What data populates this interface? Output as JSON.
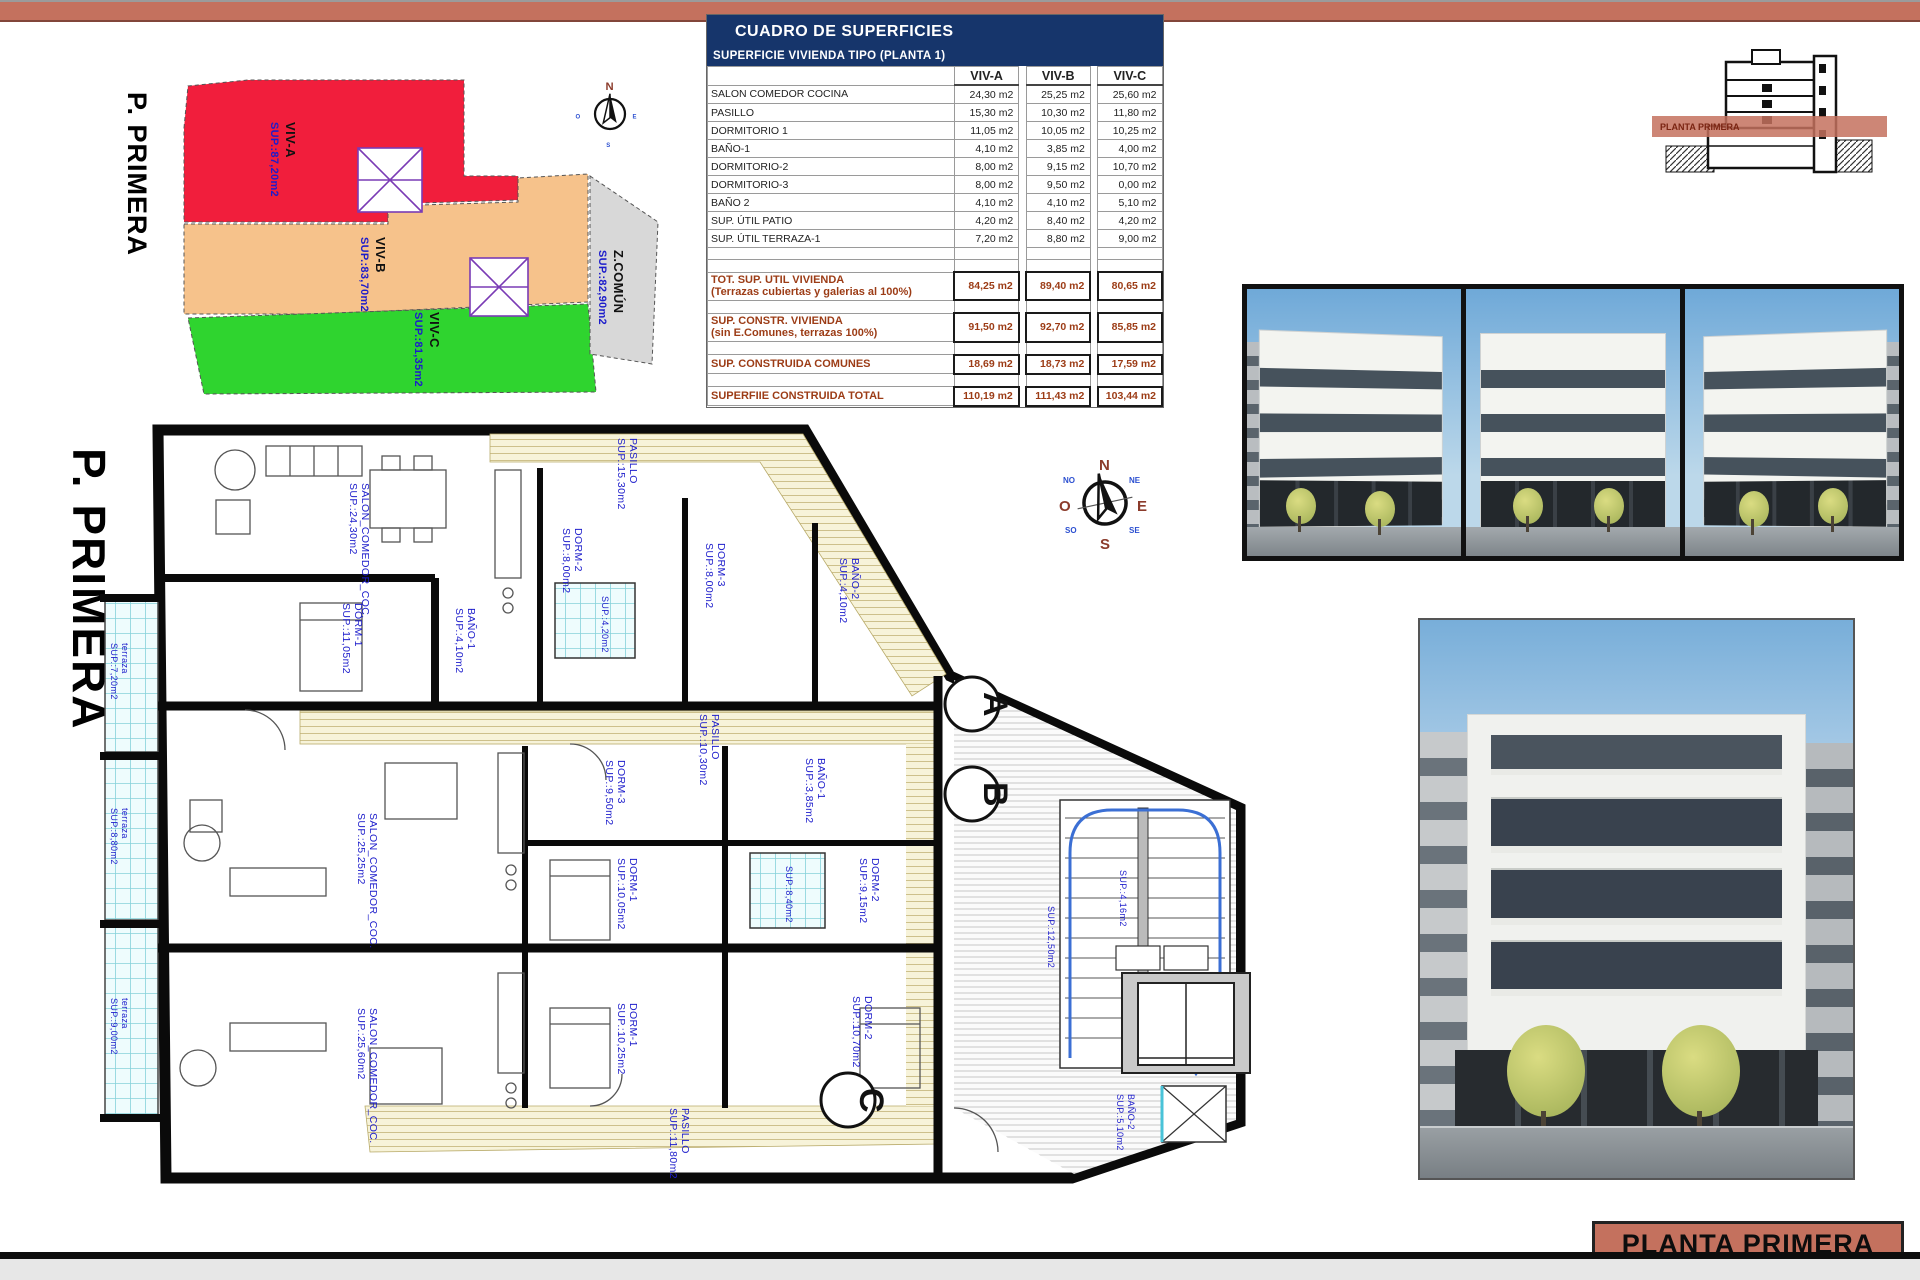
{
  "sheet": {
    "floor_label": "P. PRIMERA",
    "title_block_label": "PLANTA PRIMERA"
  },
  "colors": {
    "accent_salmon": "#c4715e",
    "table_header_navy": "#16356b",
    "zone_red": "#f11e3c",
    "zone_orange": "#f6c28b",
    "zone_green": "#2fd42f",
    "zone_grey": "#d8d8d8",
    "label_blue": "#1c1ccb",
    "summary_maroon": "#9c3c16"
  },
  "key_plan": {
    "floor_label": "P. PRIMERA",
    "zones": [
      {
        "name": "VIV-A",
        "area": "SUP.:87,20m2"
      },
      {
        "name": "VIV-B",
        "area": "SUP.:83,70m2"
      },
      {
        "name": "VIV-C",
        "area": "SUP.:81,35m2"
      },
      {
        "name": "Z.COMÚN",
        "area": "SUP.:82,90m2"
      }
    ]
  },
  "table": {
    "title": "CUADRO DE SUPERFICIES",
    "subtitle": "SUPERFICIE VIVIENDA TIPO  (PLANTA 1)",
    "columns": [
      "VIV-A",
      "VIV-B",
      "VIV-C"
    ],
    "rows": [
      {
        "label": "SALON COMEDOR COCINA",
        "a": "24,30 m2",
        "b": "25,25 m2",
        "c": "25,60 m2"
      },
      {
        "label": "PASILLO",
        "a": "15,30 m2",
        "b": "10,30 m2",
        "c": "11,80 m2"
      },
      {
        "label": "DORMITORIO 1",
        "a": "11,05 m2",
        "b": "10,05 m2",
        "c": "10,25 m2"
      },
      {
        "label": "BAÑO-1",
        "a": "4,10 m2",
        "b": "3,85 m2",
        "c": "4,00 m2"
      },
      {
        "label": "DORMITORIO-2",
        "a": "8,00 m2",
        "b": "9,15 m2",
        "c": "10,70 m2"
      },
      {
        "label": "DORMITORIO-3",
        "a": "8,00 m2",
        "b": "9,50 m2",
        "c": "0,00 m2"
      },
      {
        "label": "BAÑO 2",
        "a": "4,10 m2",
        "b": "4,10 m2",
        "c": "5,10 m2"
      },
      {
        "label": "SUP. ÚTIL PATIO",
        "a": "4,20 m2",
        "b": "8,40 m2",
        "c": "4,20 m2"
      },
      {
        "label": "SUP. ÚTIL TERRAZA-1",
        "a": "7,20 m2",
        "b": "8,80 m2",
        "c": "9,00 m2"
      }
    ],
    "summary": [
      {
        "label": "TOT. SUP. UTIL VIVIENDA",
        "sub": "(Terrazas cubiertas y galerias al 100%)",
        "a": "84,25 m2",
        "b": "89,40 m2",
        "c": "80,65 m2"
      },
      {
        "label": "SUP. CONSTR. VIVIENDA",
        "sub": "(sin E.Comunes, terrazas 100%)",
        "a": "91,50 m2",
        "b": "92,70 m2",
        "c": "85,85 m2"
      },
      {
        "label": "SUP. CONSTRUIDA COMUNES",
        "sub": "",
        "a": "18,69 m2",
        "b": "18,73 m2",
        "c": "17,59 m2"
      },
      {
        "label": "SUPERFIIE CONSTRUIDA TOTAL",
        "sub": "",
        "a": "110,19 m2",
        "b": "111,43 m2",
        "c": "103,44 m2"
      }
    ]
  },
  "section_drawing": {
    "band_label": "PLANTA PRIMERA"
  },
  "floor_plan": {
    "floor_label": "P. PRIMERA",
    "unit_markers": [
      "A",
      "B",
      "C"
    ],
    "compass": {
      "n": "N",
      "e": "E",
      "s": "S",
      "o": "O",
      "ne": "NE",
      "se": "SE",
      "so": "SO",
      "no": "NO"
    },
    "rooms": [
      {
        "name": "SALON_COMEDOR_COC.",
        "area": "SUP.:24,30m2"
      },
      {
        "name": "PASILLO",
        "area": "SUP.:15,30m2"
      },
      {
        "name": "DORM-2",
        "area": "SUP.:8,00m2"
      },
      {
        "name": "DORM-3",
        "area": "SUP.:8,00m2"
      },
      {
        "name": "BAÑO-2",
        "area": "SUP.:4,10m2"
      },
      {
        "name": "DORM-1",
        "area": "SUP.:11,05m2"
      },
      {
        "name": "BAÑO-1",
        "area": "SUP.:4,10m2"
      },
      {
        "name": "terraza",
        "area": "SUP.:7,20m2"
      },
      {
        "name": "SALON_COMEDOR_COC.",
        "area": "SUP.:25,25m2"
      },
      {
        "name": "DORM-1",
        "area": "SUP.:10,05m2"
      },
      {
        "name": "DORM-2",
        "area": "SUP.:9,15m2"
      },
      {
        "name": "DORM-3",
        "area": "SUP.:9,50m2"
      },
      {
        "name": "BAÑO-1",
        "area": "SUP.:3,85m2"
      },
      {
        "name": "PASILLO",
        "area": "SUP.:10,30m2"
      },
      {
        "name": "terraza",
        "area": "SUP.:8,80m2"
      },
      {
        "name": "SALON_COMEDOR_COC.",
        "area": "SUP.:25,60m2"
      },
      {
        "name": "DORM-1",
        "area": "SUP.:10,25m2"
      },
      {
        "name": "DORM-2",
        "area": "SUP.:10,70m2"
      },
      {
        "name": "BAÑO-2",
        "area": "SUP.:5,10m2"
      },
      {
        "name": "PASILLO",
        "area": "SUP.:11,80m2"
      },
      {
        "name": "terraza",
        "area": "SUP.:9,00m2"
      },
      {
        "name": "",
        "area": "SUP.:4,20m2"
      },
      {
        "name": "",
        "area": "SUP.:8,40m2"
      },
      {
        "name": "",
        "area": "SUP.:12,50m2"
      },
      {
        "name": "",
        "area": "SUP.:4,16m2"
      }
    ]
  }
}
